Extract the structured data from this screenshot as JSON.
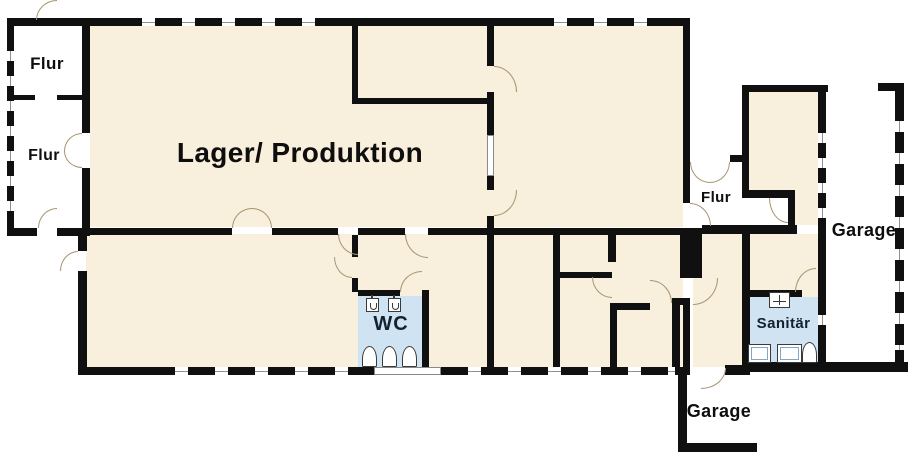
{
  "rooms": {
    "flur_top_left": {
      "label": "Flur"
    },
    "flur_mid_left": {
      "label": "Flur"
    },
    "lager_produktion": {
      "label": "Lager/ Produktion"
    },
    "wc": {
      "label": "WC"
    },
    "flur_east": {
      "label": "Flur"
    },
    "sanitaer": {
      "label": "Sanitär"
    },
    "garage_east": {
      "label": "Garage"
    },
    "garage_south": {
      "label": "Garage"
    }
  },
  "colors": {
    "room_fill": "#f8efdd",
    "wet_room_fill": "#cfe3f2",
    "wall": "#101010",
    "door_arc": "#a8946f",
    "window_line": "#909090",
    "label_color": "#0e0e0e",
    "wet_label_color": "#14212e"
  }
}
